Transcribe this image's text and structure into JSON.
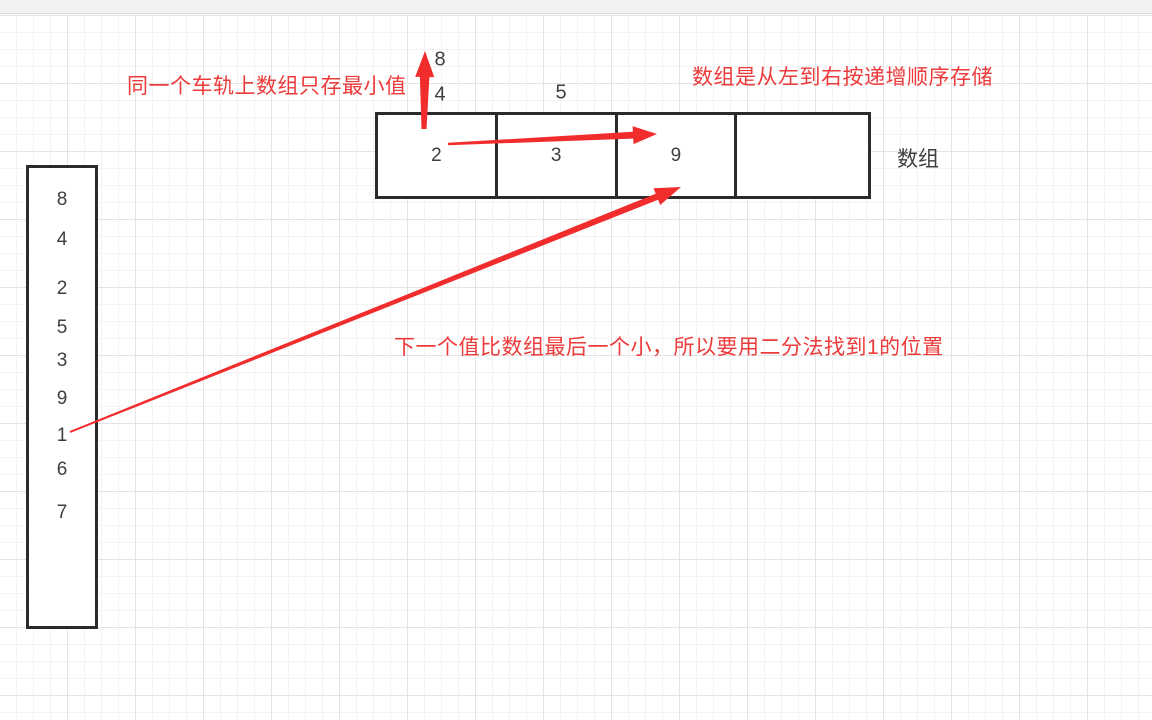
{
  "annotations": {
    "rail_note": "同一个车轨上数组只存最小值",
    "order_note": "数组是从左到右按递增顺序存储",
    "binary_search_note": "下一个值比数组最后一个小，所以要用二分法找到1的位置"
  },
  "array_box": {
    "label": "数组",
    "cells": [
      "2",
      "3",
      "9",
      ""
    ],
    "overflow_values": [
      {
        "text": "8",
        "x": 440,
        "y": 60
      },
      {
        "text": "4",
        "x": 440,
        "y": 95
      },
      {
        "text": "5",
        "x": 561,
        "y": 93
      }
    ]
  },
  "rail": {
    "values": [
      {
        "text": "8",
        "y": 32
      },
      {
        "text": "4",
        "y": 72
      },
      {
        "text": "2",
        "y": 121
      },
      {
        "text": "5",
        "y": 160
      },
      {
        "text": "3",
        "y": 193
      },
      {
        "text": "9",
        "y": 231
      },
      {
        "text": "1",
        "y": 268
      },
      {
        "text": "6",
        "y": 302
      },
      {
        "text": "7",
        "y": 345
      }
    ]
  },
  "arrows": [
    {
      "name": "arrow-up-min-value",
      "x1": 424,
      "y1": 129,
      "x2": 425,
      "y2": 51,
      "tail": 5,
      "head_len": 26,
      "head_half": 9.5
    },
    {
      "name": "arrow-cell2-to-cell9",
      "x1": 448,
      "y1": 144,
      "x2": 657,
      "y2": 134,
      "tail": 2.5,
      "head_len": 24,
      "head_half": 9
    },
    {
      "name": "arrow-value1-to-cell9",
      "x1": 70,
      "y1": 432,
      "x2": 681,
      "y2": 187,
      "tail": 2,
      "head_len": 26,
      "head_half": 9
    }
  ],
  "colors": {
    "annotation_red": "#ed3a3a",
    "arrow_red": "#f12c2c",
    "shape_stroke": "#2b2b2b",
    "text_dark": "#3f3f3f"
  }
}
